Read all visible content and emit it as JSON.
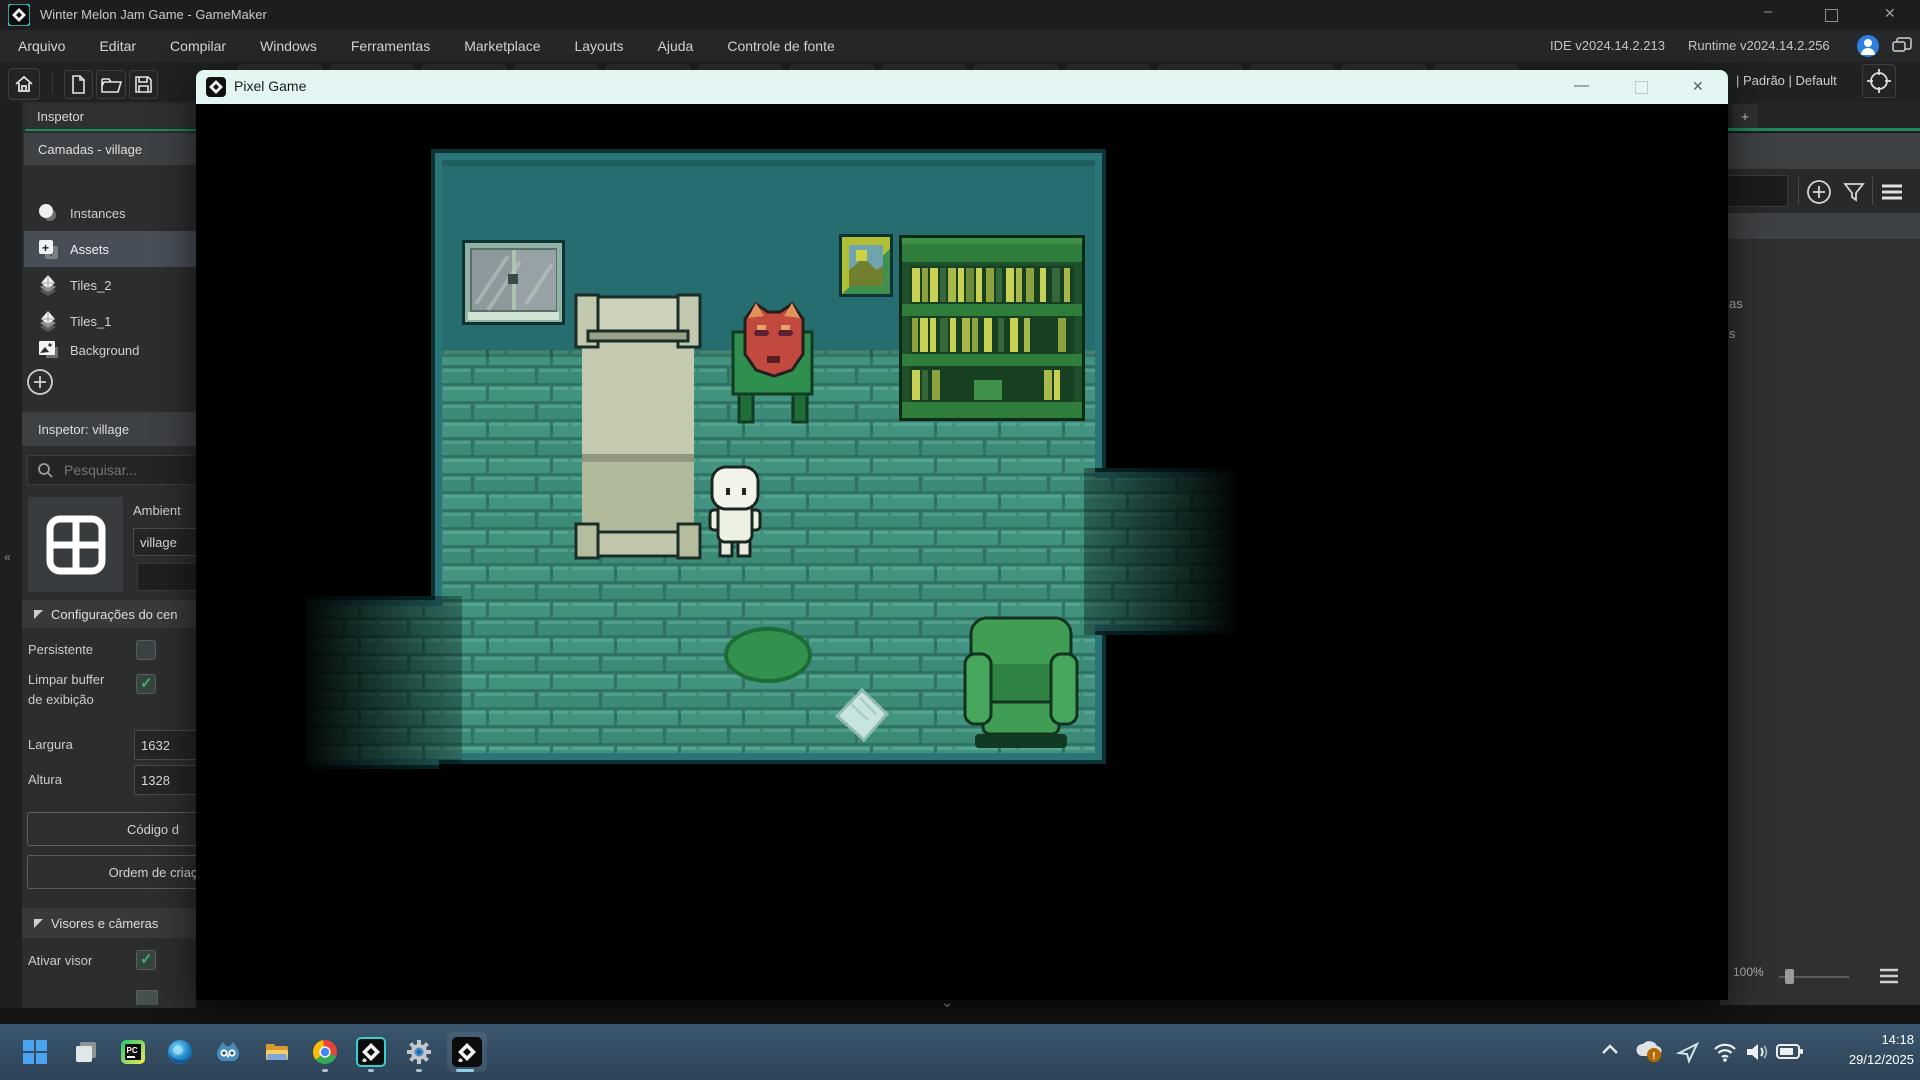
{
  "app": {
    "title": "Winter Melon Jam Game - GameMaker"
  },
  "menu": {
    "items": [
      "Arquivo",
      "Editar",
      "Compilar",
      "Windows",
      "Ferramentas",
      "Marketplace",
      "Layouts",
      "Ajuda",
      "Controle de fonte"
    ],
    "ide_version": "IDE v2024.14.2.213",
    "runtime_version": "Runtime v2024.14.2.256"
  },
  "toolbar": {
    "layout_preset": "| Padrão | Default"
  },
  "left_panel": {
    "tab_label": "Inspetor",
    "layers_header": "Camadas - village",
    "layers": [
      {
        "label": "Instances"
      },
      {
        "label": "Assets"
      },
      {
        "label": "Tiles_2"
      },
      {
        "label": "Tiles_1"
      },
      {
        "label": "Background"
      }
    ],
    "inspector_header": "Inspetor: village",
    "search_placeholder": "Pesquisar...",
    "ambient_label": "Ambient",
    "room_name": "village",
    "settings_section_label": "Configurações do cen",
    "persistent_label": "Persistente",
    "persistent_checked": false,
    "clear_buffer_label_line1": "Limpar buffer",
    "clear_buffer_label_line2": "de exibição",
    "clear_buffer_checked": true,
    "width_label": "Largura",
    "width_value": "1632",
    "height_label": "Altura",
    "height_value": "1328",
    "code_button_label": "Código d",
    "creation_order_button_label": "Ordem de criaç",
    "viewports_section_label": "Visores e câmeras",
    "enable_viewport_label": "Ativar visor",
    "enable_viewport_checked": true
  },
  "game_window": {
    "title": "Pixel Game"
  },
  "right_panel": {
    "plus_tab_label": "+",
    "text_fragment_1": "as",
    "text_fragment_2": "s",
    "zoom_level": "100%"
  },
  "taskbar": {
    "time": "14:18",
    "date": "29/12/2025"
  },
  "colors": {
    "accent_green": "#1f8a56",
    "selected_row": "#474e57",
    "check_green": "#3fae6f",
    "game_titlebar": "#e4f6f3",
    "wall_teal": "#256d6e",
    "floor_teal": "#3e8d7c",
    "room_border": "#2a7577",
    "taskbar_top": "#3a566e",
    "gm_cyan_border": "#35d0cf",
    "avatar_blue": "#2f7fe0"
  }
}
